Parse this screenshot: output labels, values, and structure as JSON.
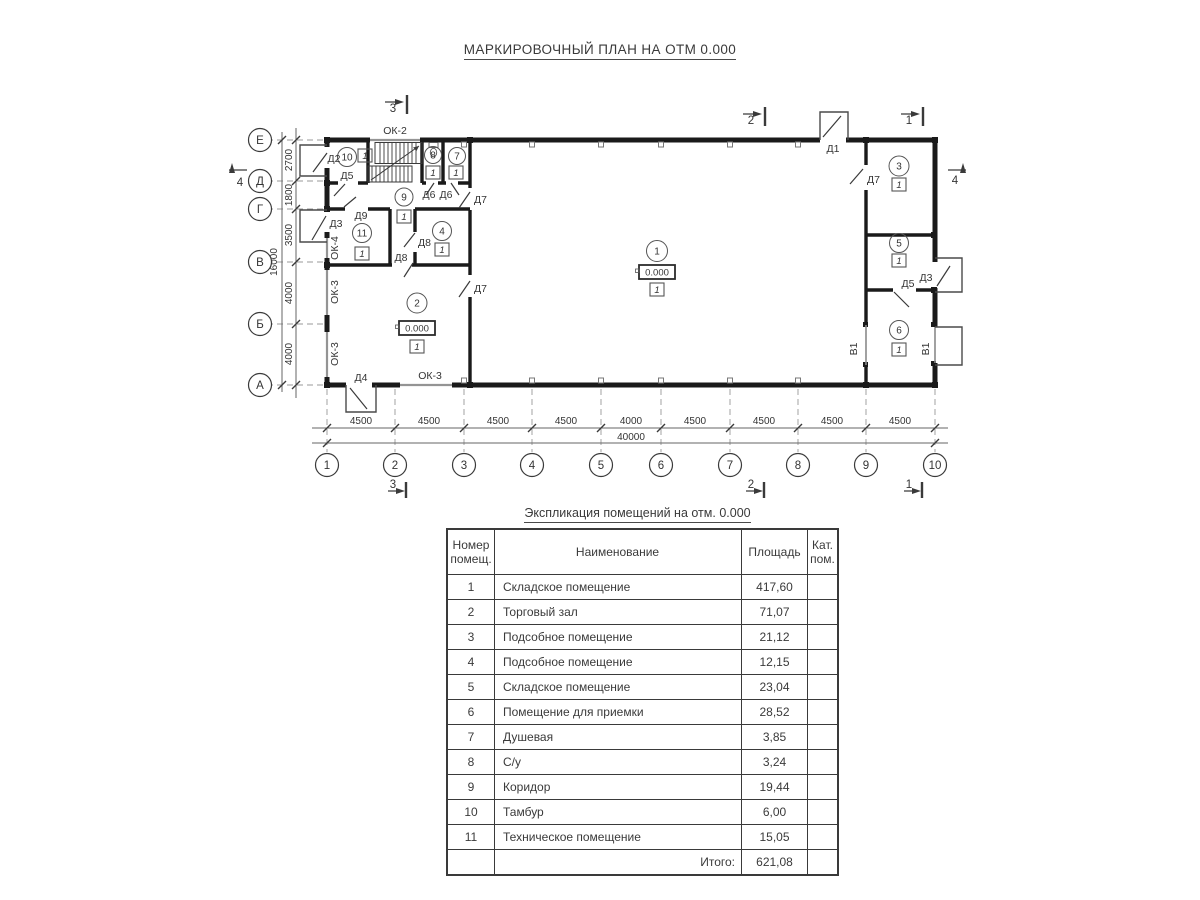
{
  "title": "МАРКИРОВОЧНЫЙ ПЛАН НА ОТМ 0.000",
  "plan": {
    "axis_letters": [
      "Е",
      "Д",
      "Г",
      "В",
      "Б",
      "А"
    ],
    "axis_numbers": [
      "1",
      "2",
      "3",
      "4",
      "5",
      "6",
      "7",
      "8",
      "9",
      "10"
    ],
    "v_dims": [
      "2700",
      "1800",
      "3500",
      "4000",
      "4000"
    ],
    "v_total": "16000",
    "h_dims": [
      "4500",
      "4500",
      "4500",
      "4500",
      "4000",
      "4500",
      "4500",
      "4500",
      "4500"
    ],
    "h_total": "40000",
    "section_marks": {
      "m1": "1",
      "m2": "2",
      "m3": "3",
      "m4": "4"
    },
    "room_numbers": [
      "1",
      "2",
      "3",
      "4",
      "5",
      "6",
      "7",
      "8",
      "9",
      "10",
      "11"
    ],
    "category_badge": "1",
    "elevation_mark": "0.000",
    "door_labels": {
      "d1": "Д1",
      "d2": "Д2",
      "d3": "Д3",
      "d4": "Д4",
      "d5": "Д5",
      "d6": "Д6",
      "d7": "Д7",
      "d8": "Д8",
      "d9": "Д9"
    },
    "window_labels": {
      "ok2": "ОК-2",
      "ok3": "ОК-3",
      "ok4": "ОК-4"
    },
    "gate_label": "В1"
  },
  "schedule": {
    "title": "Экспликация помещений на отм. 0.000",
    "col_num_l1": "Номер",
    "col_num_l2": "помещ.",
    "col_name": "Наименование",
    "col_area": "Площадь",
    "col_cat_l1": "Кат.",
    "col_cat_l2": "пом.",
    "rows": [
      {
        "num": "1",
        "name": "Складское помещение",
        "area": "417,60"
      },
      {
        "num": "2",
        "name": "Торговый зал",
        "area": "71,07"
      },
      {
        "num": "3",
        "name": "Подсобное помещение",
        "area": "21,12"
      },
      {
        "num": "4",
        "name": "Подсобное помещение",
        "area": "12,15"
      },
      {
        "num": "5",
        "name": "Складское помещение",
        "area": "23,04"
      },
      {
        "num": "6",
        "name": "Помещение для приемки",
        "area": "28,52"
      },
      {
        "num": "7",
        "name": "Душевая",
        "area": "3,85"
      },
      {
        "num": "8",
        "name": "С/у",
        "area": "3,24"
      },
      {
        "num": "9",
        "name": "Коридор",
        "area": "19,44"
      },
      {
        "num": "10",
        "name": "Тамбур",
        "area": "6,00"
      },
      {
        "num": "11",
        "name": "Техническое помещение",
        "area": "15,05"
      }
    ],
    "total_label": "Итого:",
    "total_value": "621,08"
  }
}
